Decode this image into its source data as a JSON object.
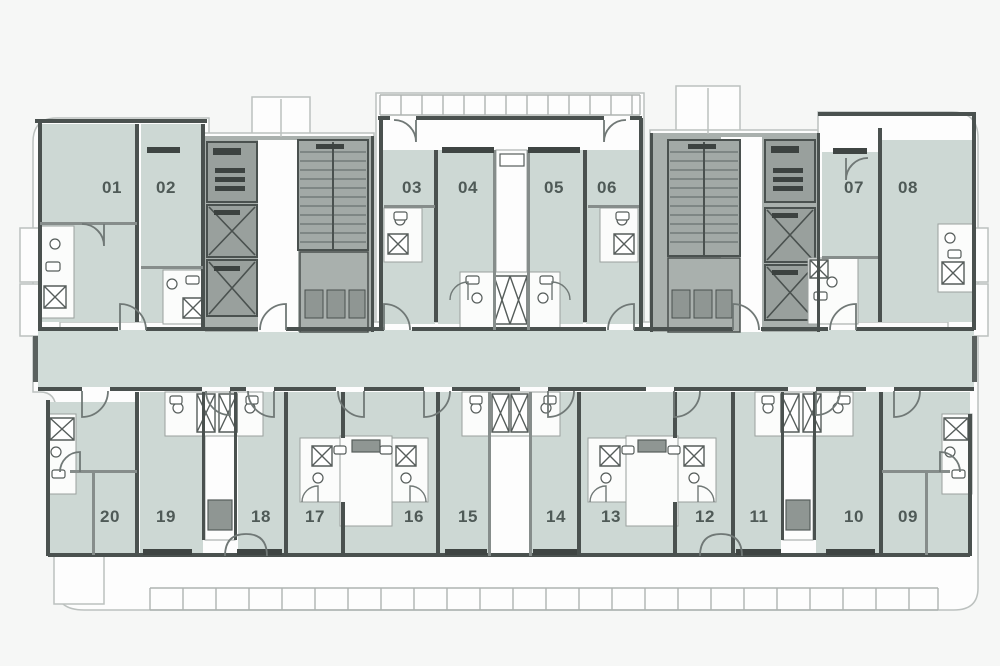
{
  "plan": {
    "type": "residential-floor-plan",
    "colors": {
      "background": "#f6f7f6",
      "unit_fill": "#cdd8d4",
      "corridor_fill": "#d1dcd8",
      "core_fill": "#a9b0ad",
      "core_box_fill": "#99a09d",
      "wall_dark": "#4a514f",
      "wall_mid": "#868d8b",
      "white": "#fdfdfd",
      "outline": "#bcc1bf",
      "window_bar": "#3f4543",
      "label_text": "#4f5a57"
    },
    "top_units": [
      {
        "number": "01"
      },
      {
        "number": "02"
      },
      {
        "number": "03"
      },
      {
        "number": "04"
      },
      {
        "number": "05"
      },
      {
        "number": "06"
      },
      {
        "number": "07"
      },
      {
        "number": "08"
      }
    ],
    "bottom_units": [
      {
        "number": "20"
      },
      {
        "number": "19"
      },
      {
        "number": "18"
      },
      {
        "number": "17"
      },
      {
        "number": "16"
      },
      {
        "number": "15"
      },
      {
        "number": "14"
      },
      {
        "number": "13"
      },
      {
        "number": "12"
      },
      {
        "number": "11"
      },
      {
        "number": "10"
      },
      {
        "number": "09"
      }
    ]
  }
}
